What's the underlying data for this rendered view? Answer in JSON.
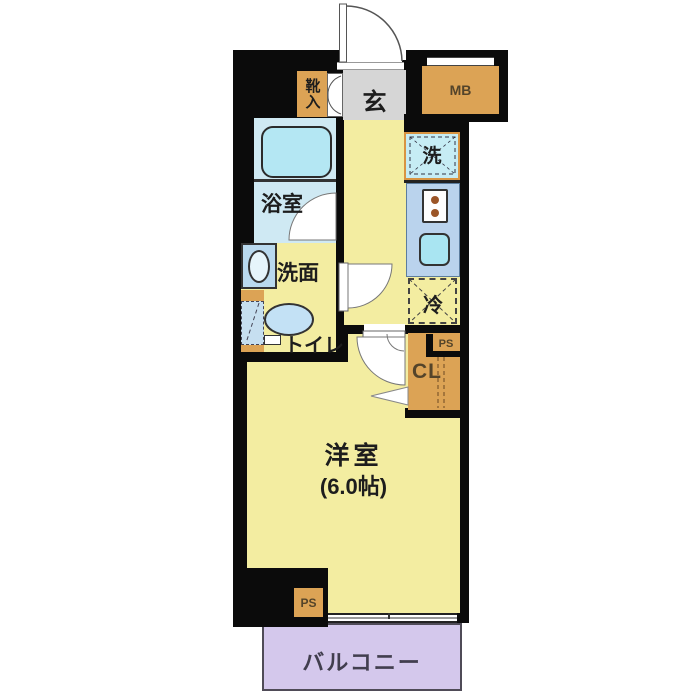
{
  "floorplan": {
    "entrance": {
      "label": "玄"
    },
    "shoe_cabinet": {
      "label": "靴入"
    },
    "meter_box": {
      "label": "MB"
    },
    "bathroom": {
      "label": "浴室"
    },
    "washroom": {
      "label": "洗面"
    },
    "toilet": {
      "label": "トイレ"
    },
    "laundry": {
      "label": "洗"
    },
    "refrigerator": {
      "label": "冷"
    },
    "pipe_space_upper": {
      "label": "PS"
    },
    "closet": {
      "label": "CL"
    },
    "pipe_space_lower": {
      "label": "PS"
    },
    "main_room": {
      "label": "洋室",
      "size": "(6.0帖)"
    },
    "balcony": {
      "label": "バルコニー"
    }
  },
  "colors": {
    "wall": "#0b0b0b",
    "floor_yellow": "#f3eda1",
    "storage_orange": "#dca355",
    "entrance_gray": "#d6d6d6",
    "bath_blue": "#cfe9f3",
    "tub_blue": "#b4e7f3",
    "counter_blue": "#bad3ed",
    "sink_cyan": "#a9e5f2",
    "balcony_purple": "#d4c8ec"
  }
}
